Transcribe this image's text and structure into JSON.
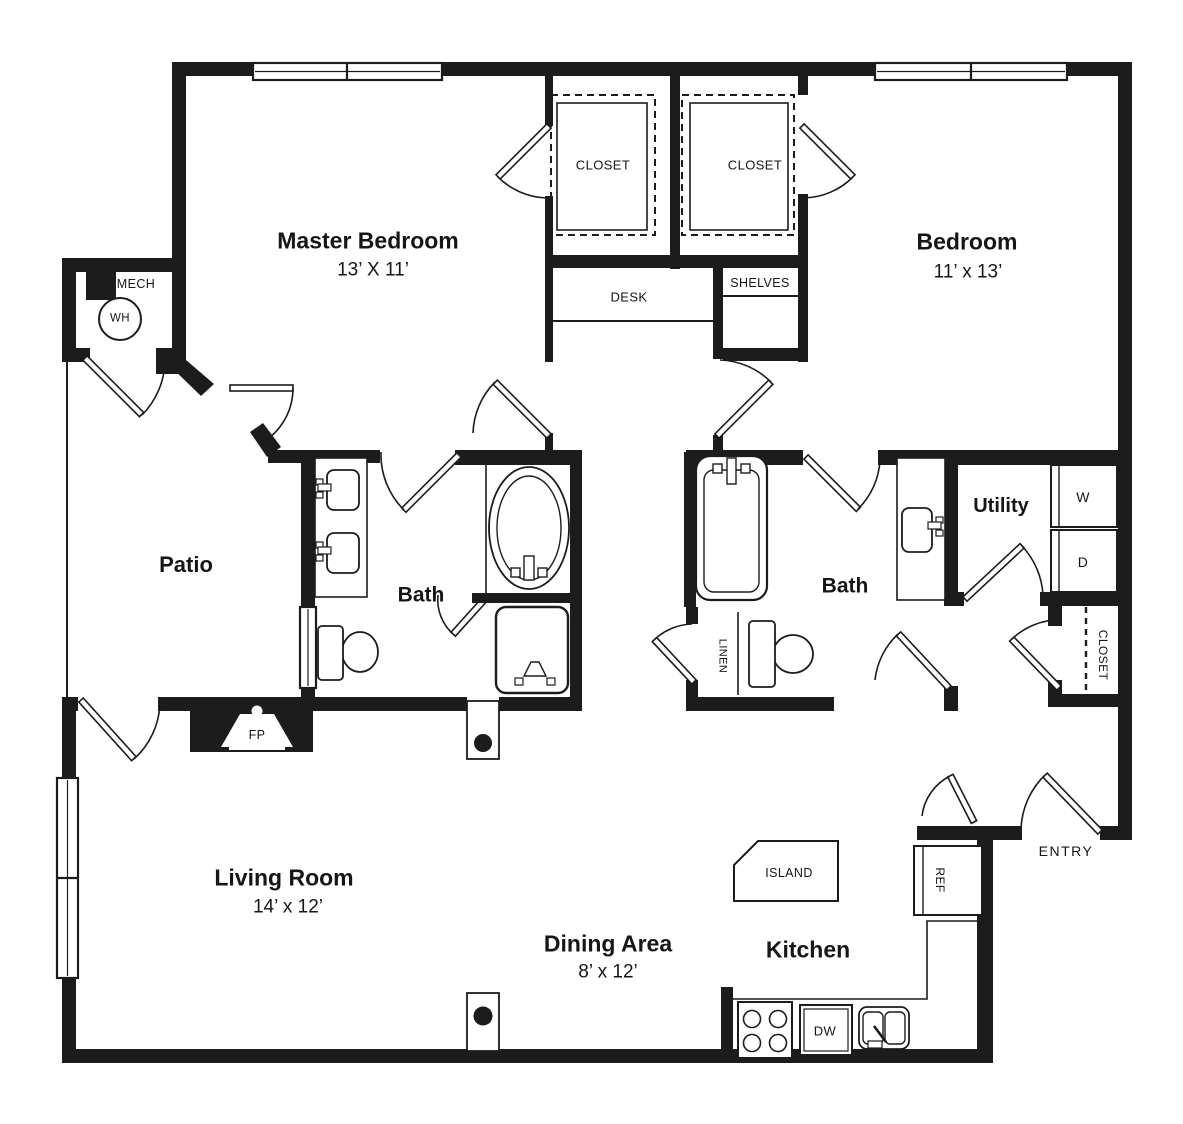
{
  "plan": {
    "title": "Two bedroom two bath apartment floor plan",
    "colors": {
      "wall": "#1c1c1c",
      "background": "#ffffff",
      "text": "#161616"
    },
    "rooms": {
      "master_bedroom": {
        "name": "Master Bedroom",
        "dims": "13’ X 11’"
      },
      "bedroom": {
        "name": "Bedroom",
        "dims": "11’ x 13’"
      },
      "living_room": {
        "name": "Living Room",
        "dims": "14’ x 12’"
      },
      "dining_area": {
        "name": "Dining Area",
        "dims": "8’ x 12’"
      },
      "kitchen": {
        "name": "Kitchen"
      },
      "patio": {
        "name": "Patio"
      },
      "master_bath": {
        "name": "Bath"
      },
      "bath2": {
        "name": "Bath"
      },
      "utility": {
        "name": "Utility"
      }
    },
    "fixtures": {
      "closet_master": "CLOSET",
      "closet_bedroom": "CLOSET",
      "closet_hall": "CLOSET",
      "desk": "DESK",
      "shelves": "SHELVES",
      "mech": "MECH",
      "water_heater": "WH",
      "linen": "LINEN",
      "washer": "W",
      "dryer": "D",
      "refrigerator": "REF",
      "dishwasher": "DW",
      "island": "ISLAND",
      "fireplace": "FP",
      "entry": "ENTRY"
    }
  }
}
